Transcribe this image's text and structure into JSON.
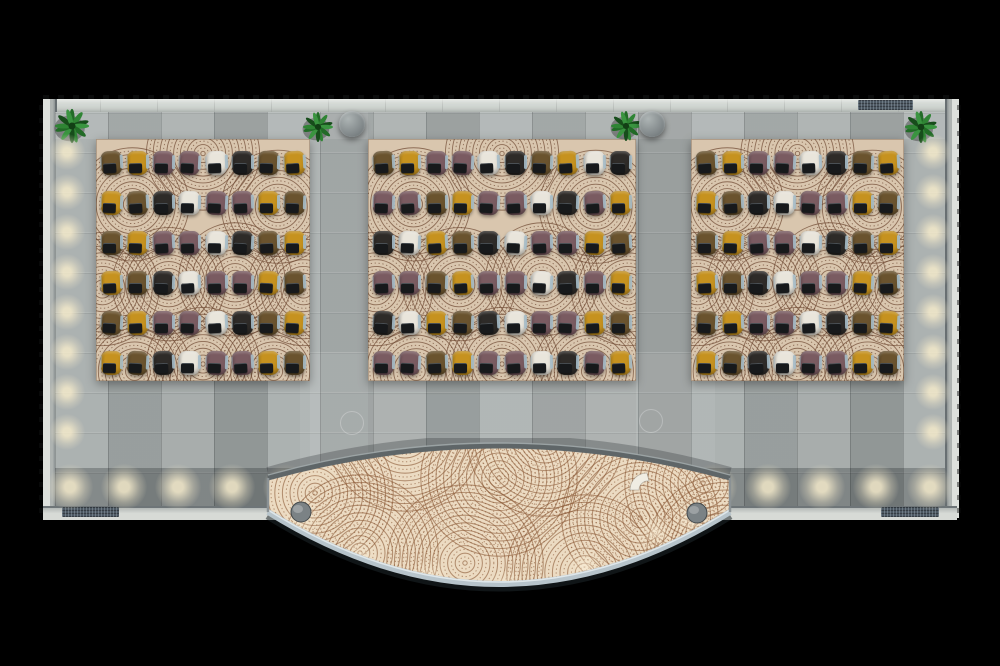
{
  "meta": {
    "description": "Top-down 3D architectural render of an open lounge hall: three circle-patterned rugs filled with tablet armchairs, gray tiled floor, wall planters, and a curved lens-shaped reception desk with a concentric-ring wood top.",
    "canvas": {
      "width": 1000,
      "height": 666,
      "background": "#000000"
    }
  },
  "palette": {
    "chair_colors": {
      "Y": "#c6921f",
      "B": "#6a532e",
      "M": "#7a5b61",
      "D": "#2e2b28",
      "W": "#e9e5db"
    },
    "chair_tablet": "#17191b",
    "chair_arm": "#a6bcc8",
    "rug_base": "#d9c6ae",
    "rug_line": "#6f4a33",
    "floor_base": "#a4aaa9",
    "wall_light": "#d7dad6",
    "wall_dark": "#6e7578",
    "desk_wood": "#ecdbc2",
    "desk_ring": "#8a5836",
    "desk_rim": "#b7c4cb",
    "desk_shell": "#5f6668",
    "post_gray": "#7b8285",
    "plant_greens": [
      "#226b27",
      "#2f8434",
      "#174d1b",
      "#3a9440"
    ],
    "glow": "#f3e9ca"
  },
  "legend": {
    "Y": "mustard-yellow chair",
    "B": "olive-brown chair",
    "M": "mauve-plum chair",
    "D": "charcoal chair",
    "W": "cream-white chair"
  },
  "counts": {
    "rugs": 3,
    "chairs_total": 156,
    "chairs_left_rug": 48,
    "chairs_middle_rug": 60,
    "chairs_right_rug": 48,
    "plants": 4,
    "wall_columns": 2,
    "desk_posts": 2
  },
  "scene": {
    "rugs": [
      {
        "id": "left",
        "x": 96,
        "y": 139,
        "w": 214,
        "h": 242,
        "rows": [
          "BYMMWDBY",
          "YBDWMMYB",
          "BYMMWDBY",
          "YBDWMMYB",
          "BYMMWDBY",
          "YBDWMMYB"
        ]
      },
      {
        "id": "middle",
        "x": 368,
        "y": 139,
        "w": 268,
        "h": 242,
        "rows": [
          "BYMMWDBYWD",
          "MMBYMMWDMY",
          "DWYBDWMMYB",
          "MMBYMMWDMY",
          "DWYBDWMMYB",
          "MMBYMMWDMY"
        ]
      },
      {
        "id": "right",
        "x": 691,
        "y": 139,
        "w": 213,
        "h": 242,
        "rows": [
          "BYMMWDBY",
          "YBDWMMYB",
          "BYMMWDBY",
          "YBDWMMYB",
          "BYMMWDBY",
          "YBDWMMYB"
        ]
      }
    ],
    "rug_ring_centers": [
      [
        0.17,
        0.27
      ],
      [
        0.5,
        0.06
      ],
      [
        0.85,
        0.28
      ],
      [
        0.03,
        0.62
      ],
      [
        0.34,
        0.6
      ],
      [
        0.65,
        0.58
      ],
      [
        0.97,
        0.62
      ],
      [
        0.18,
        0.96
      ],
      [
        0.5,
        0.93
      ],
      [
        0.83,
        0.96
      ]
    ],
    "plants": [
      {
        "x": 72,
        "y": 126,
        "r": 16
      },
      {
        "x": 318,
        "y": 127,
        "r": 14
      },
      {
        "x": 626,
        "y": 126,
        "r": 14
      },
      {
        "x": 921,
        "y": 127,
        "r": 15
      }
    ],
    "columns": [
      {
        "x": 352,
        "y": 124,
        "r": 13
      },
      {
        "x": 652,
        "y": 124,
        "r": 13
      }
    ],
    "mats": [
      {
        "x": 62,
        "y": 507,
        "w": 57,
        "h": 10
      },
      {
        "x": 881,
        "y": 507,
        "w": 58,
        "h": 10
      },
      {
        "x": 858,
        "y": 100,
        "w": 55,
        "h": 10
      }
    ],
    "floor_circles": [
      {
        "x": 351,
        "y": 422,
        "r": 11
      },
      {
        "x": 650,
        "y": 420,
        "r": 11
      }
    ],
    "wall_glows": {
      "left_x": 67,
      "right_x": 933,
      "side_ys": [
        152,
        192,
        232,
        272,
        312,
        352,
        392,
        432
      ],
      "bottom_y": 487,
      "bottom_xs": [
        70,
        124,
        178,
        232,
        286,
        714,
        768,
        822,
        876,
        930
      ]
    },
    "desk": {
      "x": 255,
      "y": 438,
      "w": 480,
      "h": 170,
      "lens": {
        "left_x": 13,
        "right_x": 475,
        "tip_top_y": 40,
        "tip_bottom_y": 74,
        "top_control": [
          244,
          -24
        ],
        "bottom_control": [
          244,
          218
        ]
      },
      "posts": [
        {
          "cx": 46,
          "cy": 74,
          "r": 10
        },
        {
          "cx": 442,
          "cy": 75,
          "r": 10
        }
      ],
      "ring_centers": [
        [
          60,
          55
        ],
        [
          150,
          -5
        ],
        [
          244,
          40
        ],
        [
          210,
          125
        ],
        [
          105,
          115
        ],
        [
          330,
          135
        ],
        [
          385,
          80
        ],
        [
          448,
          45
        ],
        [
          470,
          115
        ],
        [
          290,
          0
        ]
      ],
      "glows": [
        [
          48,
          80
        ],
        [
          105,
          120
        ],
        [
          175,
          140
        ],
        [
          250,
          150
        ],
        [
          330,
          128
        ],
        [
          400,
          95
        ],
        [
          436,
          80
        ]
      ],
      "crescent": {
        "x": 375,
        "y": 52
      }
    }
  }
}
